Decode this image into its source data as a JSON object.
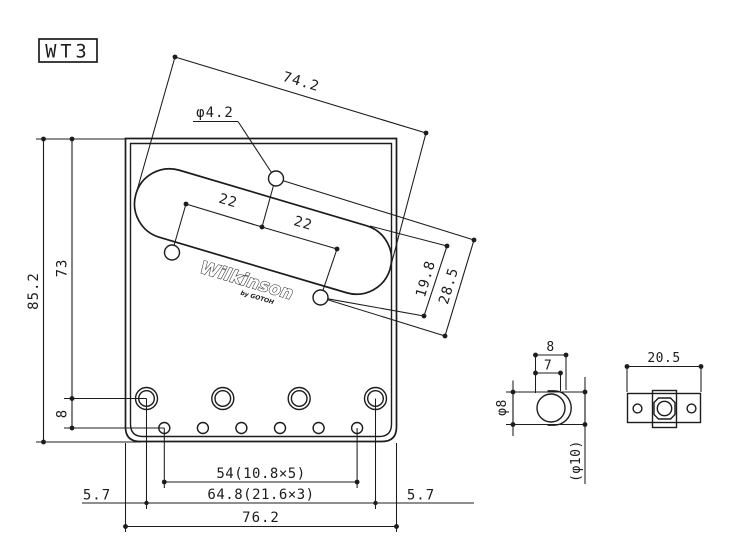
{
  "drawing": {
    "model": "WT3",
    "logo": {
      "brand": "Wilkinson",
      "byline": "by GOTOH"
    },
    "colors": {
      "line": "#1c1c1c",
      "background": "#ffffff"
    },
    "front_view": {
      "labels": {
        "slot_length": "74.2",
        "center_hole_diameter": "φ4.2",
        "spacing_left": "22",
        "spacing_right": "22",
        "offset_inner": "19.8",
        "offset_outer": "28.5",
        "plate_height": "85.2",
        "saddle_row_height": "73",
        "string_row_offset": "8",
        "string_hole_span": "54(10.8×5)",
        "saddle_screw_span": "64.8(21.6×3)",
        "plate_width": "76.2",
        "margin_left": "5.7",
        "margin_right": "5.7"
      }
    },
    "saddle_section_view": {
      "labels": {
        "overall_width": "8",
        "inner_width": "7",
        "barrel_diameter": "φ8",
        "reference_diameter": "(φ10)"
      }
    },
    "saddle_top_view": {
      "labels": {
        "overall_length": "20.5"
      }
    }
  }
}
